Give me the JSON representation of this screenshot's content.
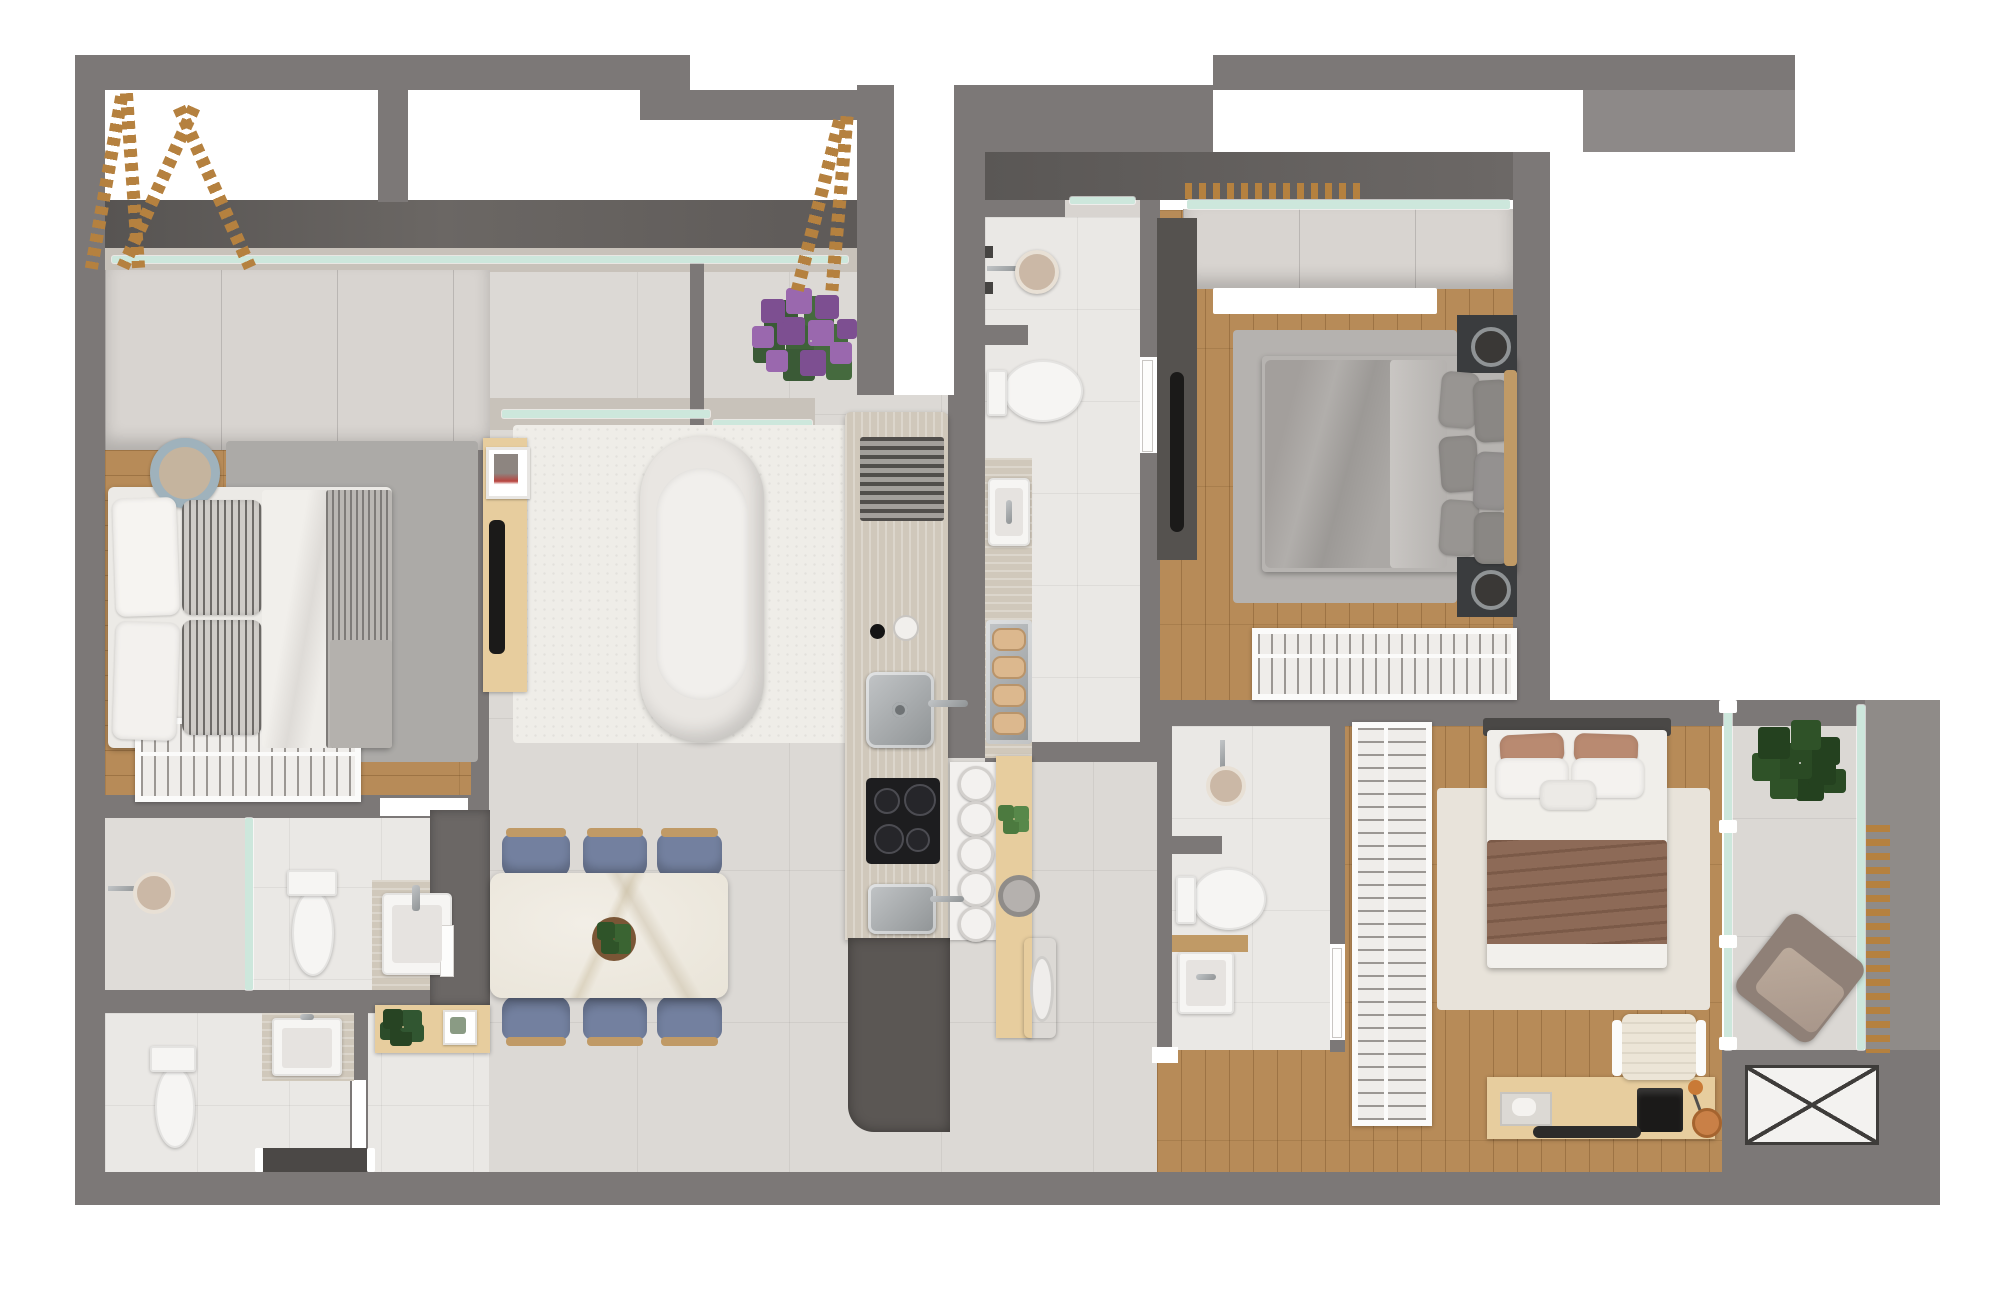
{
  "meta": {
    "kind": "floor-plan-render",
    "view": "top-down 3D architectural render",
    "visible_text": "none"
  },
  "palette": {
    "wall": "#7c7877",
    "wall-light": "#8d8988",
    "concrete": "#615d5b",
    "concrete2": "#8f8b88",
    "ledge": "#c8c2ba",
    "glass": "#cde7dc",
    "cabinet": "#d8d4d0",
    "woodfloor": "#b78b58",
    "wood-light": "#e7cd9e",
    "wood-mid": "#c09a66",
    "tile": "#dcd9d5",
    "btile": "#eae8e5",
    "rug-white": "#efede8",
    "rug-gray": "#acaaa7",
    "rug-gray2": "#b5b2af",
    "rug-beige": "#e8e3da",
    "sofa": "#e9e6e2",
    "chair-blue": "#73809f",
    "trav": "#d0c8bb",
    "steel-a": "#c2c5c7",
    "steel-b": "#8f9395",
    "appl-dark": "#5b5754",
    "cooktop": "#1d1d1f",
    "fixture": "#f6f5f3",
    "duvet-gray": "#a8a5a2",
    "duvet-brown": "#8d6a57",
    "pillow-brown": "#b98a71",
    "headboard": "#4a4846",
    "ladder": "#b5813f",
    "plant-dark": "#2e4a2d",
    "plant-mid": "#43683c",
    "flower": "#9a68ae",
    "flower2": "#7d4f91",
    "xline": "#3e3c3a",
    "black": "#1b1a19",
    "lamp-orange": "#c97a36"
  },
  "rooms": [
    {
      "id": "terrace-top-left",
      "label": "terrace with decorative ladders"
    },
    {
      "id": "bedroom-1",
      "label": "bedroom with double bed and wardrobe"
    },
    {
      "id": "bathroom-1",
      "label": "ensuite bathroom: shower, toilet, vanity"
    },
    {
      "id": "lavabo",
      "label": "guest toilet with console"
    },
    {
      "id": "living-room",
      "label": "living room with sofa, rug, TV sideboard"
    },
    {
      "id": "dining-area",
      "label": "dining table with six blue chairs"
    },
    {
      "id": "kitchen",
      "label": "galley kitchen island: vent, sinks, cooktop"
    },
    {
      "id": "laundry",
      "label": "laundry nook with washer and bar counter"
    },
    {
      "id": "bathroom-2",
      "label": "middle bathroom: shower, toilet, vanity, towels"
    },
    {
      "id": "bedroom-2",
      "label": "bedroom with gray bed, nightstands, closet, balcony strip"
    },
    {
      "id": "bedroom-3",
      "label": "bedroom with brown bed, tall wardrobe, desk"
    },
    {
      "id": "bathroom-3",
      "label": "bottom-right bathroom"
    },
    {
      "id": "balcony-right",
      "label": "balcony with plant, lounge chair, slat screen"
    },
    {
      "id": "service-area",
      "label": "technical box marked with X"
    }
  ],
  "furniture_inventory": {
    "beds": 3,
    "sofas": 1,
    "dining_chairs": 6,
    "bar_stools": 5,
    "toilets": 4,
    "sinks": 5,
    "showers": 3,
    "washing_machines": 1,
    "wardrobes": 4,
    "plants": 6,
    "ladders": 3,
    "tv_screens": 2,
    "nightstands": 2,
    "desks": 1,
    "lounge_chairs": 1,
    "office_chairs": 1
  }
}
